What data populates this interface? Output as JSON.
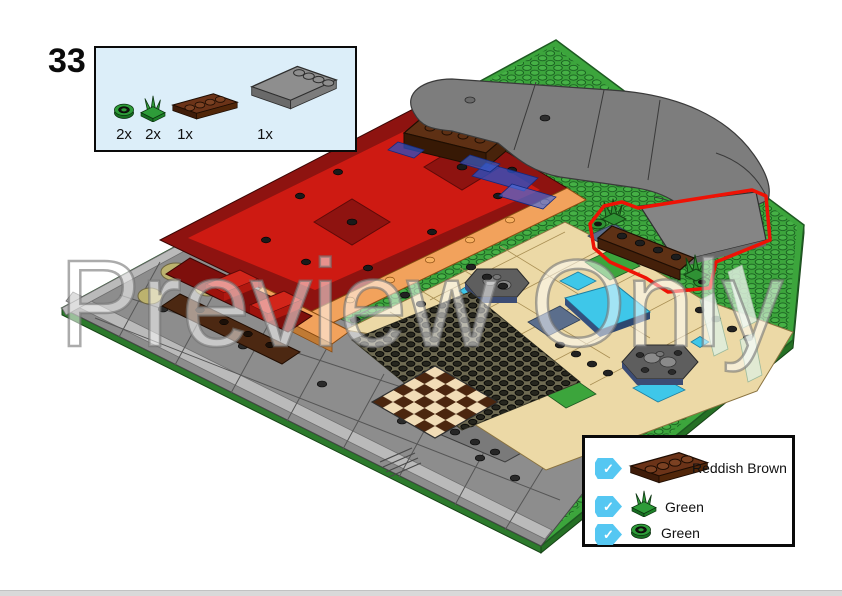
{
  "page": {
    "step_number": "33",
    "watermark_text": "Preview Only",
    "background_color": "#FFFFFF",
    "bottom_bar_color": "#D9D9D9"
  },
  "parts_callout": {
    "background_color": "#DCEEF9",
    "border_color": "#0A0A0A",
    "items": [
      {
        "part": "round-plate-1x1-green",
        "qty": "2x",
        "color": "#2E9C39"
      },
      {
        "part": "plant-flower-stem-green",
        "qty": "2x",
        "color": "#2E9C39"
      },
      {
        "part": "plate-1x4-reddish-brown",
        "qty": "1x",
        "color": "#6B3318"
      },
      {
        "part": "tile-4x4-edge-studs-dark-gray",
        "qty": "1x",
        "color": "#8E8E8E"
      }
    ]
  },
  "legend": {
    "check_glyph": "✓",
    "checkbox_color": "#55C7F2",
    "rows": [
      {
        "part": "plate-1x4",
        "label": "Reddish Brown",
        "color": "#6B3318",
        "checked": true
      },
      {
        "part": "plant-flower-stem",
        "label": "Green",
        "color": "#2E9C39",
        "checked": true
      },
      {
        "part": "round-plate-1x1",
        "label": "Green",
        "color": "#2E9C39",
        "checked": true
      }
    ]
  },
  "illustration": {
    "highlight_color": "#EE1205",
    "baseplate_green": "#3CA53C",
    "road_gray": "#7D7D7D",
    "plaza_red": "#CE1A12",
    "plaza_dark_red": "#8E1310",
    "path_tan": "#ECD9A6",
    "water_cyan": "#3EC7E9",
    "sidewalk_gray": "#8D8D8D"
  }
}
